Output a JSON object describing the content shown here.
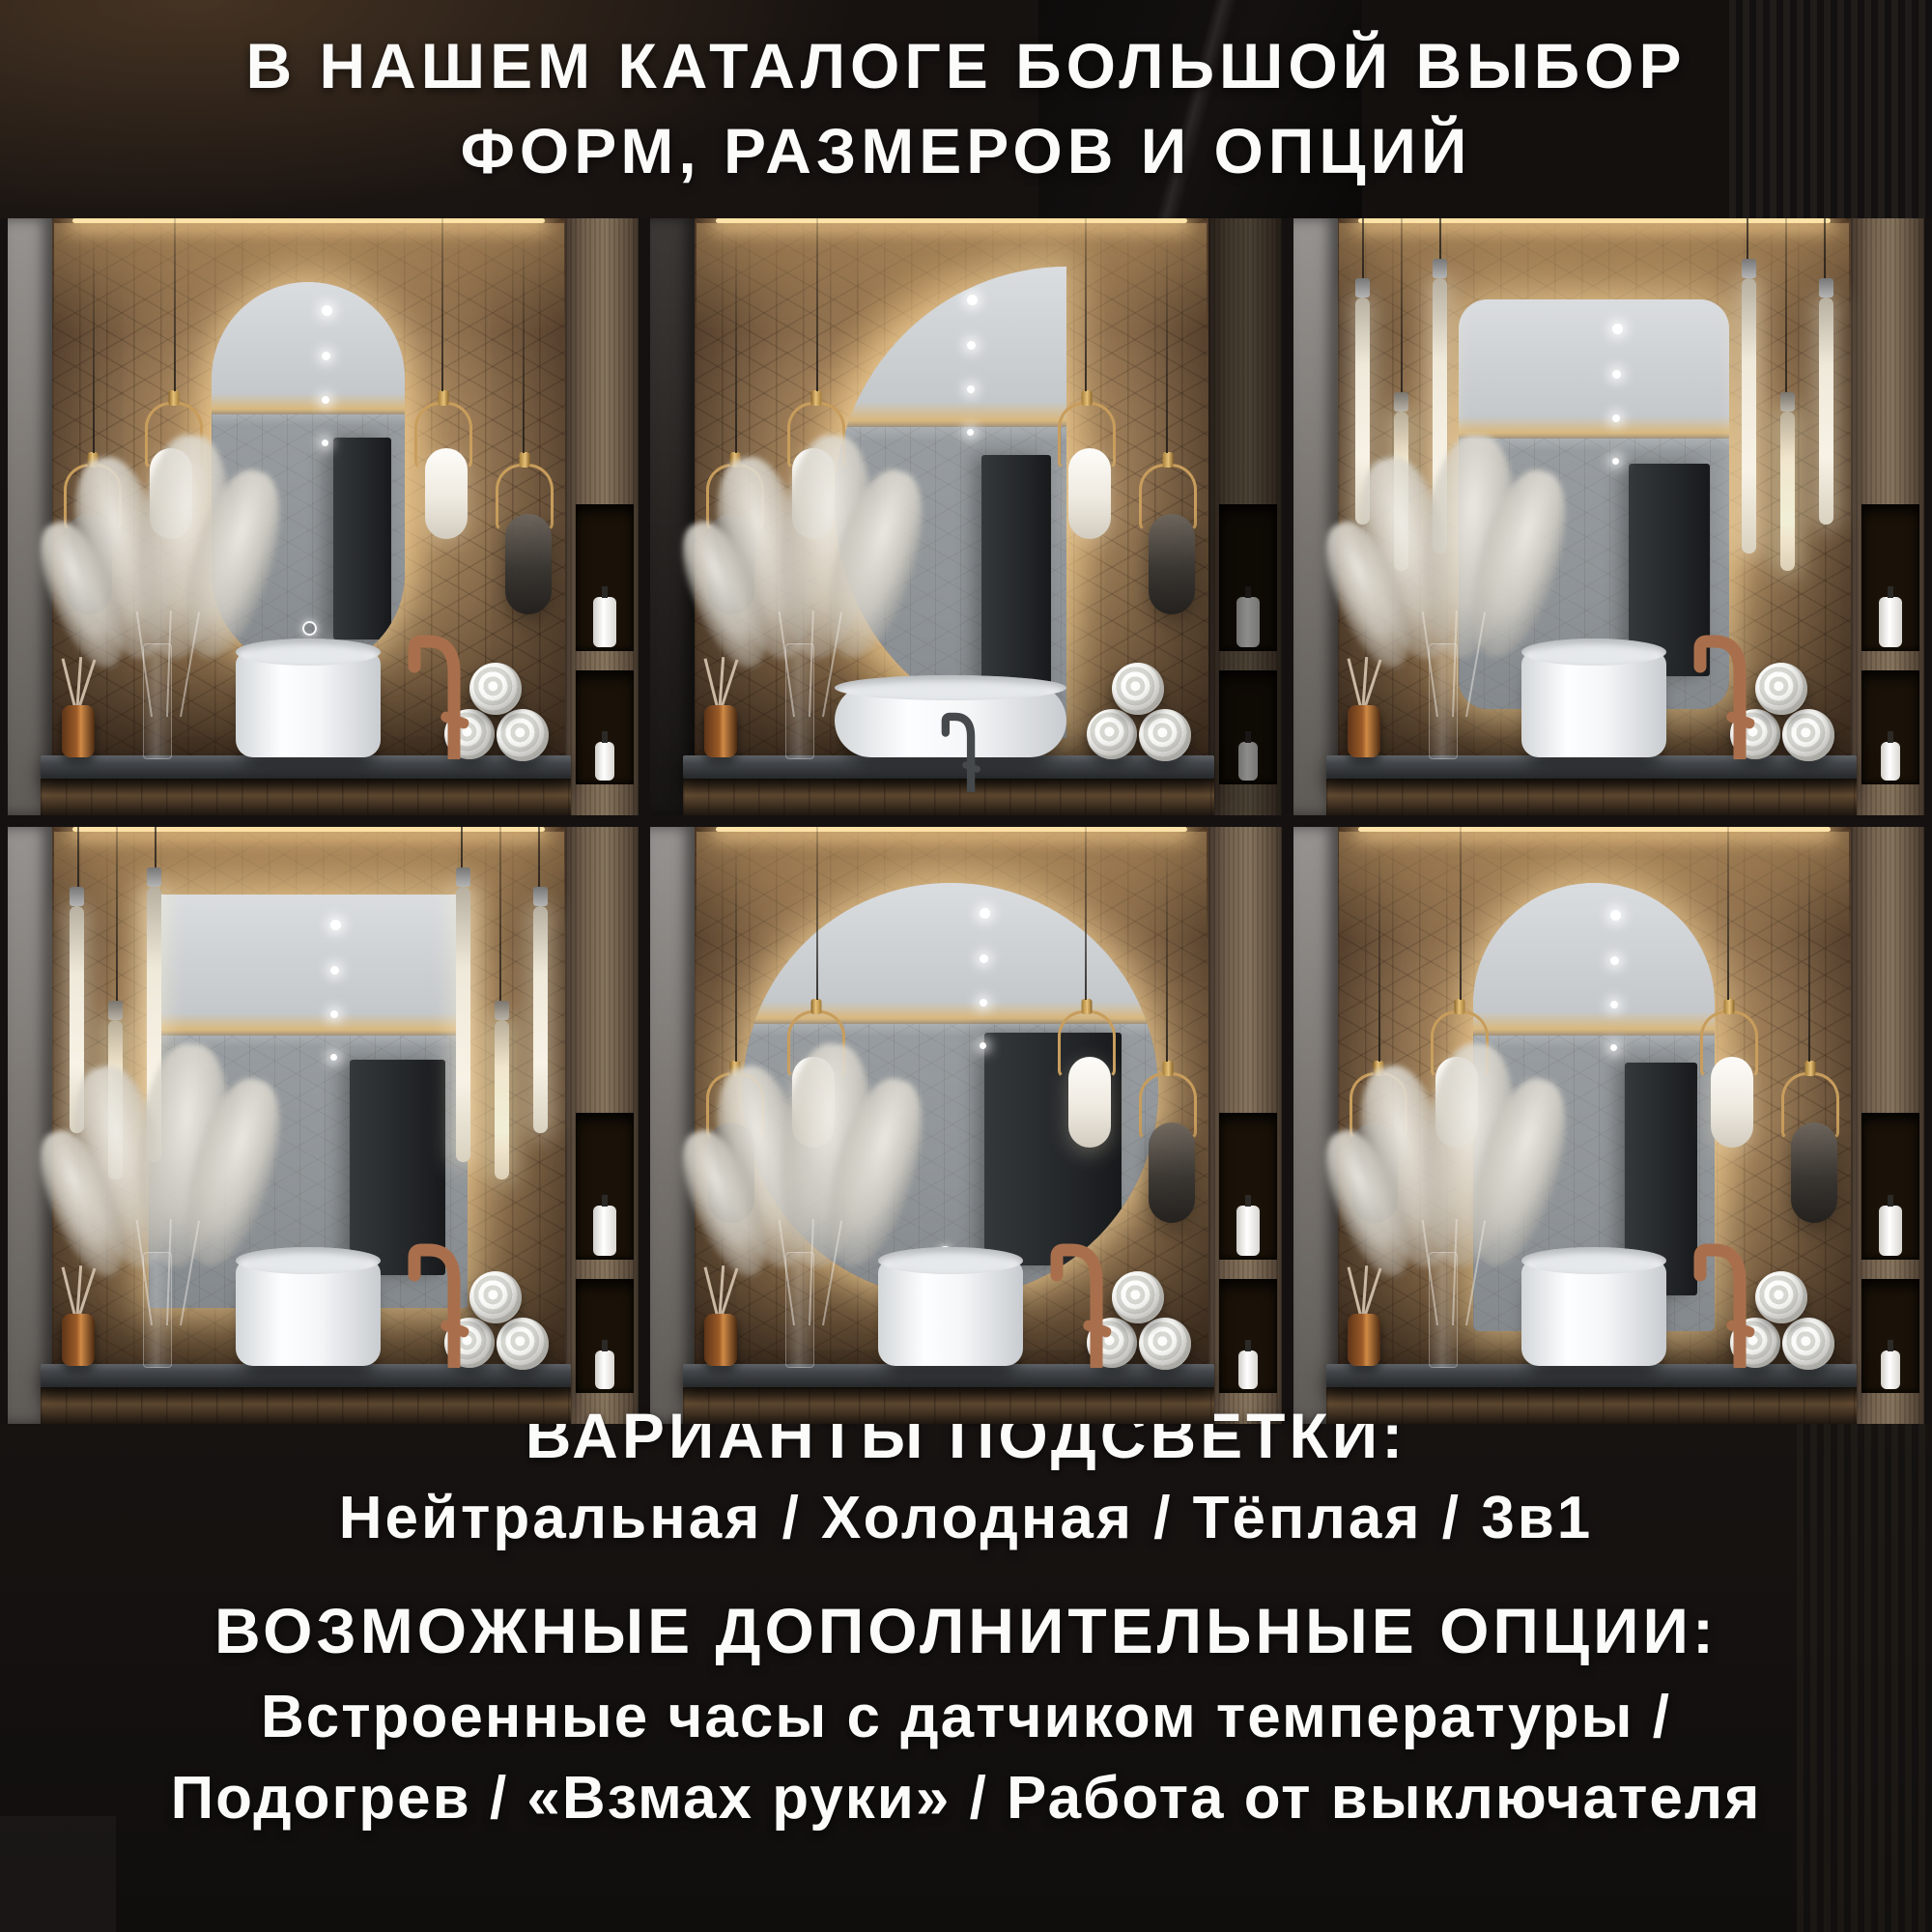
{
  "header": {
    "line1": "В НАШЕМ КАТАЛОГЕ БОЛЬШОЙ ВЫБОР",
    "line2": "ФОРМ, РАЗМЕРОВ И ОПЦИЙ"
  },
  "sections": {
    "lighting": {
      "title": "ВАРИАНТЫ ПОДСВЕТКИ:",
      "options": "Нейтральная / Холодная / Тёплая / 3в1"
    },
    "extras": {
      "title": "ВОЗМОЖНЫЕ ДОПОЛНИТЕЛЬНЫЕ ОПЦИИ:",
      "line1": "Встроенные часы с датчиком температуры /",
      "line2": "Подогрев / «Взмах руки» / Работа от выключателя"
    }
  },
  "tiles": [
    {
      "id": "oval",
      "shape": "pill",
      "lamps": "capsule",
      "sink": "round",
      "faucet": "copper",
      "flank": "light"
    },
    {
      "id": "half-moon",
      "shape": "half",
      "lamps": "capsule",
      "sink": "oval",
      "faucet": "black",
      "flank": "dark"
    },
    {
      "id": "rounded-rectangle",
      "shape": "rrect",
      "lamps": "tube",
      "sink": "round",
      "faucet": "copper",
      "flank": "light"
    },
    {
      "id": "rectangle",
      "shape": "rect",
      "lamps": "tube",
      "sink": "round",
      "faucet": "copper",
      "flank": "light"
    },
    {
      "id": "round",
      "shape": "circle",
      "lamps": "capsule",
      "sink": "round",
      "faucet": "copper",
      "flank": "light"
    },
    {
      "id": "arch",
      "shape": "arch",
      "lamps": "capsule",
      "sink": "round",
      "faucet": "copper",
      "flank": "light"
    }
  ],
  "colors": {
    "page_background": "#141110",
    "headline_text": "#fbfbfa",
    "mosaic_wall": "#86694b",
    "backlight_glow": "#ffe3a8",
    "mirror_glass": "#9aa0a4",
    "countertop": "#44484c",
    "faucet_copper": "#a96f4c",
    "faucet_black": "#46494c",
    "lamp_gold": "#c89d5c"
  }
}
